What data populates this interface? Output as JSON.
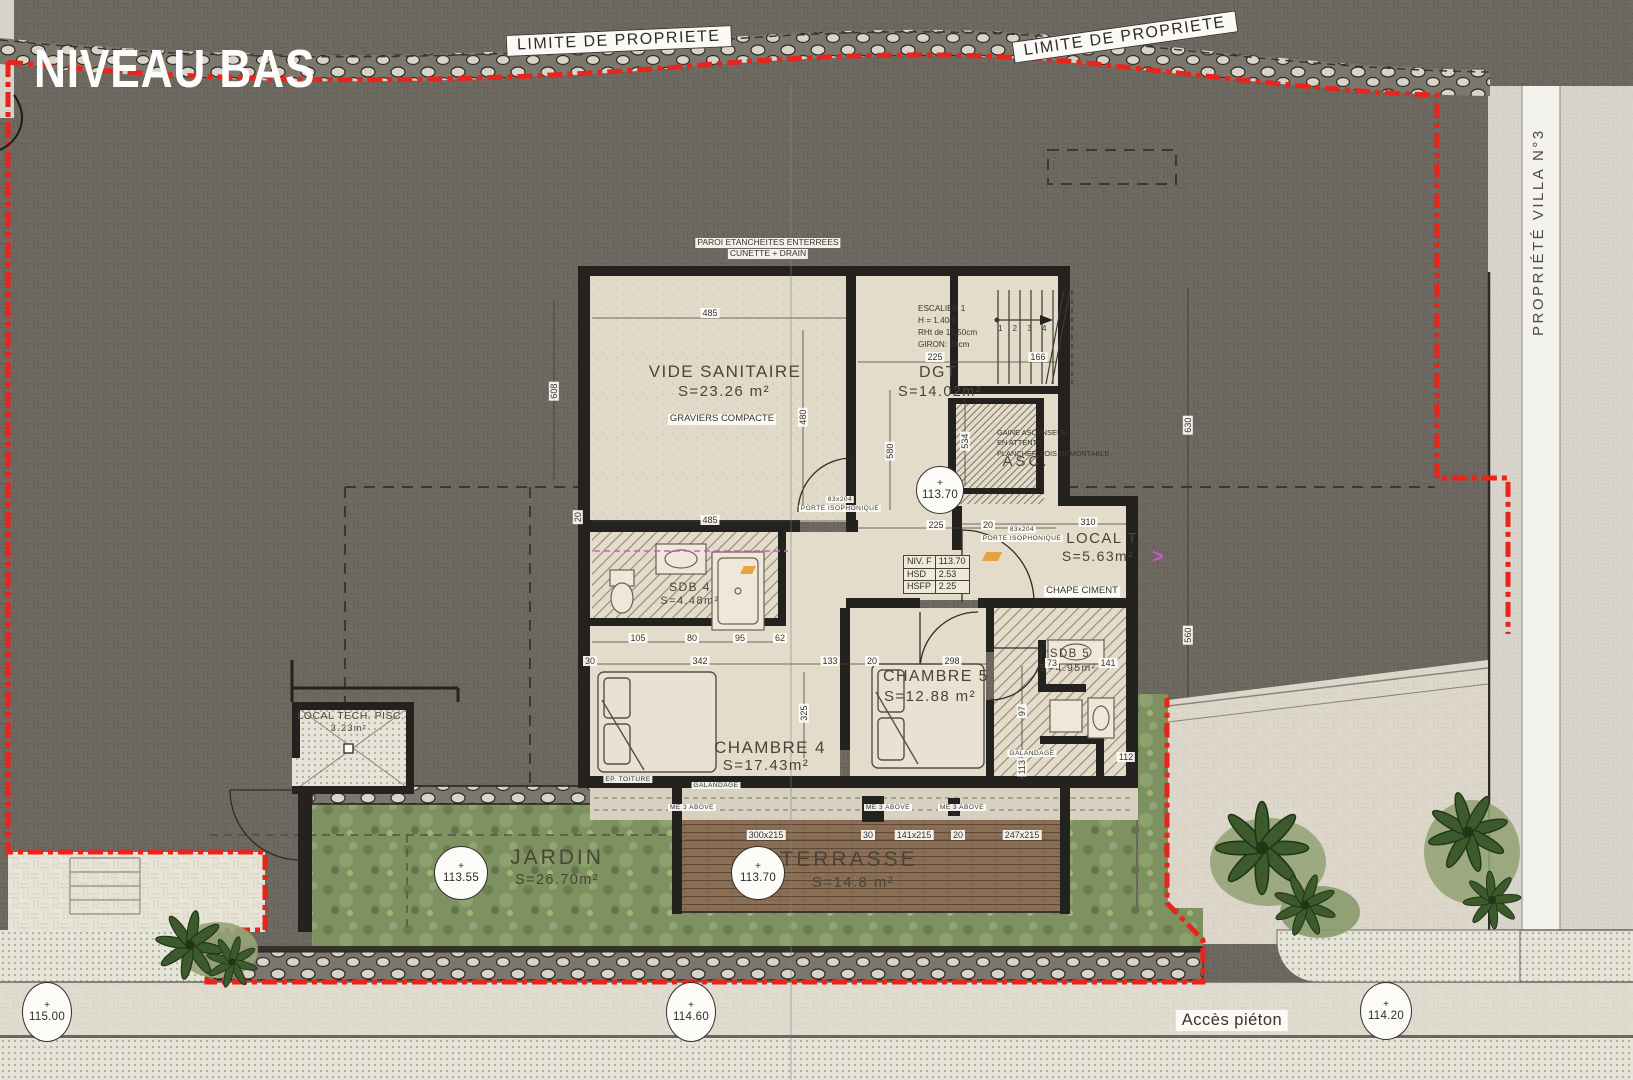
{
  "title": "NIVEAU BAS",
  "boundary": {
    "limite_1": "LIMITE DE PROPRIETE",
    "limite_2": "LIMITE DE PROPRIETE",
    "villa": "PROPRIÉTÉ VILLA N°3"
  },
  "rooms": {
    "vide_sanitaire": {
      "name": "VIDE SANITAIRE",
      "area": "S=23.26 m²",
      "note": "GRAVIERS COMPACTE"
    },
    "dgt": {
      "name": "DGT",
      "area": "S=14.02m²"
    },
    "asc": {
      "name": "ASC."
    },
    "local_t": {
      "name": "LOCAL T.",
      "area": "S=5.63m²",
      "note": "CHAPE CIMENT"
    },
    "sdb4": {
      "name": "SDB 4",
      "area": "S=4.48m²"
    },
    "chambre4": {
      "name": "CHAMBRE 4",
      "area": "S=17.43m²"
    },
    "chambre5": {
      "name": "CHAMBRE 5",
      "area": "S=12.88 m²"
    },
    "sdb5": {
      "name": "SDB 5",
      "area": "S=4.95m²"
    },
    "jardin": {
      "name": "JARDIN",
      "area": "S=26.70m²"
    },
    "terrasse": {
      "name": "TERRASSE",
      "area": "S=14.8 m²"
    },
    "local_tech": {
      "name": "LOCAL TECH. PISC.",
      "area": "3.23m²"
    }
  },
  "stair": {
    "title": "ESCALIER 1",
    "line1": "H = 1.40m",
    "line2": "RHt de 17.50cm",
    "line3": "GIRON: 28cm",
    "treads": "1   2   3   4"
  },
  "elevator_note": {
    "l1": "GAINE ASCENSEUR",
    "l2": "EN ATTENTE",
    "l3": "PLANCHER BOIS DEMONTABLE"
  },
  "site_note": {
    "l1": "PAROI ETANCHEITES ENTERREES",
    "l2": "CUNETTE + DRAIN"
  },
  "level_table": {
    "rows": [
      [
        "NIV. F",
        "113.70"
      ],
      [
        "HSD",
        "2.53"
      ],
      [
        "HSFP",
        "2.25"
      ]
    ]
  },
  "levels": {
    "plus": "+",
    "plan": "113.70",
    "jardin": "113.55",
    "terrasse": "113.70",
    "path_w": "115.00",
    "path_c": "114.60",
    "path_e": "114.20"
  },
  "doors": {
    "d1": "83x204",
    "d1t": "PORTE ISOPHONIQUE",
    "d2": "83x204",
    "d2t": "PORTE ISOPHONIQUE"
  },
  "small_notes": {
    "ep": "EP. TOITURE",
    "gal1": "GALANDAGE",
    "gal2": "GALANDAGE",
    "me1": "ME 3 ABOVE",
    "me2": "ME 3 ABOVE",
    "me3": "ME 3 ABOVE",
    "acces": "Accès piéton",
    "chevron": ">"
  },
  "dims": {
    "d1": "485",
    "d2": "485",
    "d3": "480",
    "d4": "608",
    "d5": "225",
    "d6": "166",
    "d7": "534",
    "d8": "580",
    "d9": "225",
    "d10": "20",
    "d11": "310",
    "d12": "105",
    "d13": "80",
    "d14": "95",
    "d15": "62",
    "d16": "342",
    "d17": "133",
    "d18": "20",
    "d19": "298",
    "d20": "30",
    "d21": "325",
    "d22": "73",
    "d23": "141",
    "d24": "97",
    "d25": "113",
    "d26": "112",
    "d27": "300x215",
    "d28": "30",
    "d29": "141x215",
    "d30": "20",
    "d31": "247x215",
    "d32": "20",
    "d33": "630",
    "d34": "560"
  },
  "palette": {
    "boundary_red": "#e8241b",
    "background": "#6e6a62",
    "room_fill": "#e4dccb",
    "terrace_wood": "#8c6f54",
    "garden_green": "#7e9160",
    "path_beige": "#e0dcd0"
  }
}
